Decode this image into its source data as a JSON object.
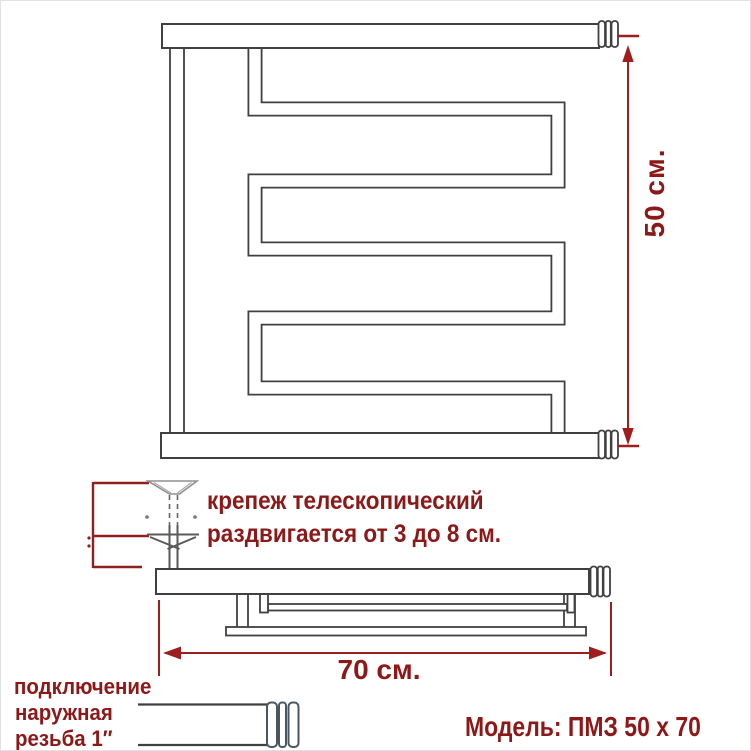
{
  "drawing_title": "Модель: ПМЗ 50 х 70",
  "front_view": {
    "height_label": "50 см."
  },
  "top_view": {
    "width_label": "70 см."
  },
  "mount_note": {
    "line1": "крепеж телескопический",
    "line2": "раздвигается от 3 до 8 см."
  },
  "connection_note": {
    "line1": "подключение",
    "line2": "наружная",
    "line3": "резьба 1″"
  },
  "colors": {
    "drawing_line": "#404040",
    "dimension_red": "#9e1e1e",
    "text_red": "#8c1818",
    "coupling_ring": "#4a5663",
    "detail_gray": "#5a5a5a"
  }
}
